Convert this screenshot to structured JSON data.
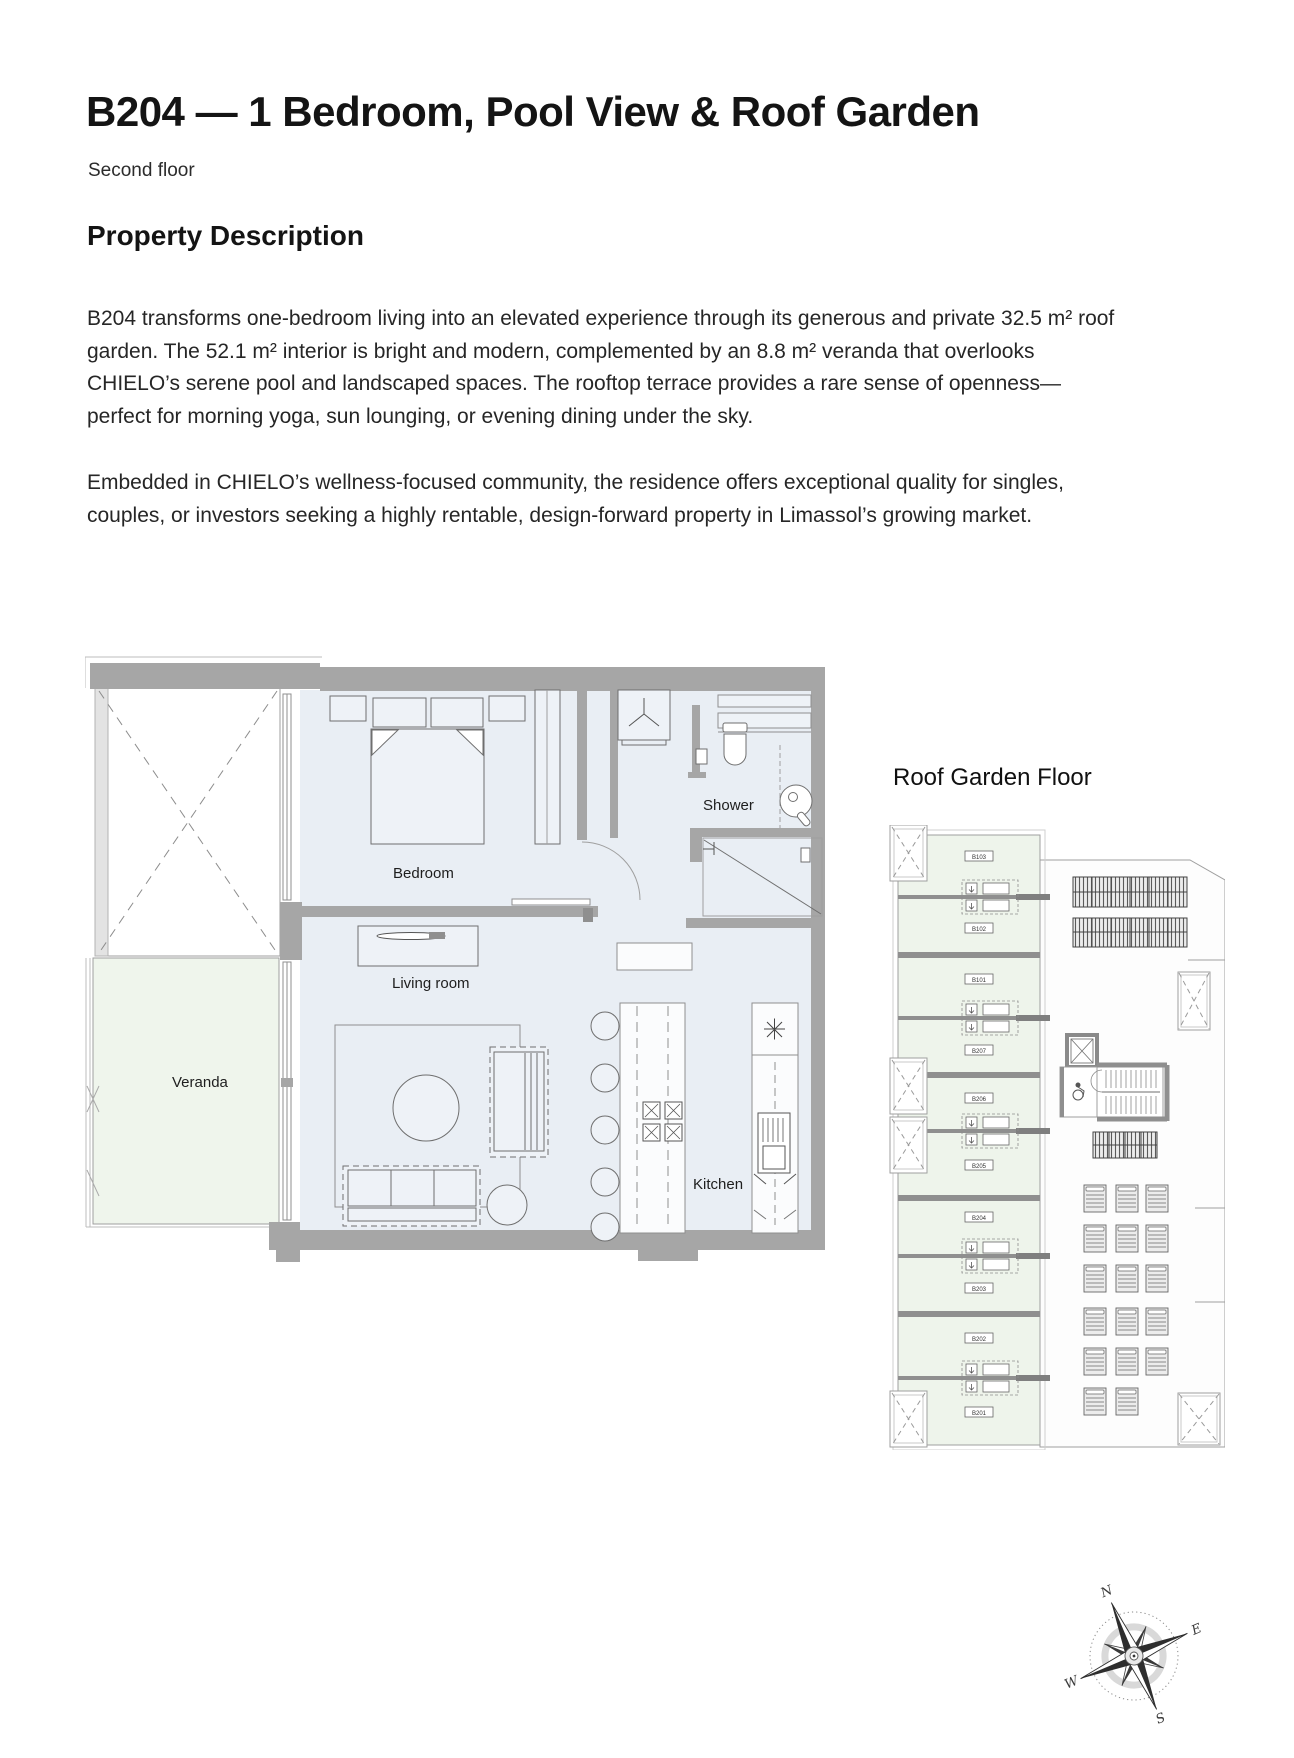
{
  "page": {
    "title": "B204 — 1 Bedroom, Pool View & Roof Garden",
    "subtitle": "Second floor",
    "section_heading": "Property Description",
    "paragraph1": "B204 transforms one-bedroom living into an elevated experience through its generous and private 32.5 m² roof garden. The 52.1 m² interior is bright and modern, complemented by an 8.8 m² veranda that overlooks CHIELO’s serene pool and landscaped spaces. The rooftop terrace provides a rare sense of openness—perfect for morning yoga, sun lounging, or evening dining under the sky.",
    "paragraph2": "Embedded in CHIELO’s wellness-focused community, the residence offers exceptional quality for singles, couples, or investors seeking a highly rentable, design-forward property in Limassol’s growing market."
  },
  "floorplan": {
    "labels": {
      "bedroom": "Bedroom",
      "living_room": "Living room",
      "veranda": "Veranda",
      "kitchen": "Kitchen",
      "shower": "Shower"
    }
  },
  "roof_plan": {
    "title": "Roof Garden Floor",
    "units": [
      "B103",
      "B102",
      "B101",
      "B207",
      "B206",
      "B205",
      "B204",
      "B203",
      "B202",
      "B201"
    ]
  },
  "compass": {
    "n": "N",
    "e": "E",
    "s": "S",
    "w": "W"
  },
  "colors": {
    "interior": "#e9eef4",
    "garden": "#eef4eb",
    "wall": "#a6a6a6",
    "line": "#6f6f6f",
    "text": "#1a1a1a"
  }
}
